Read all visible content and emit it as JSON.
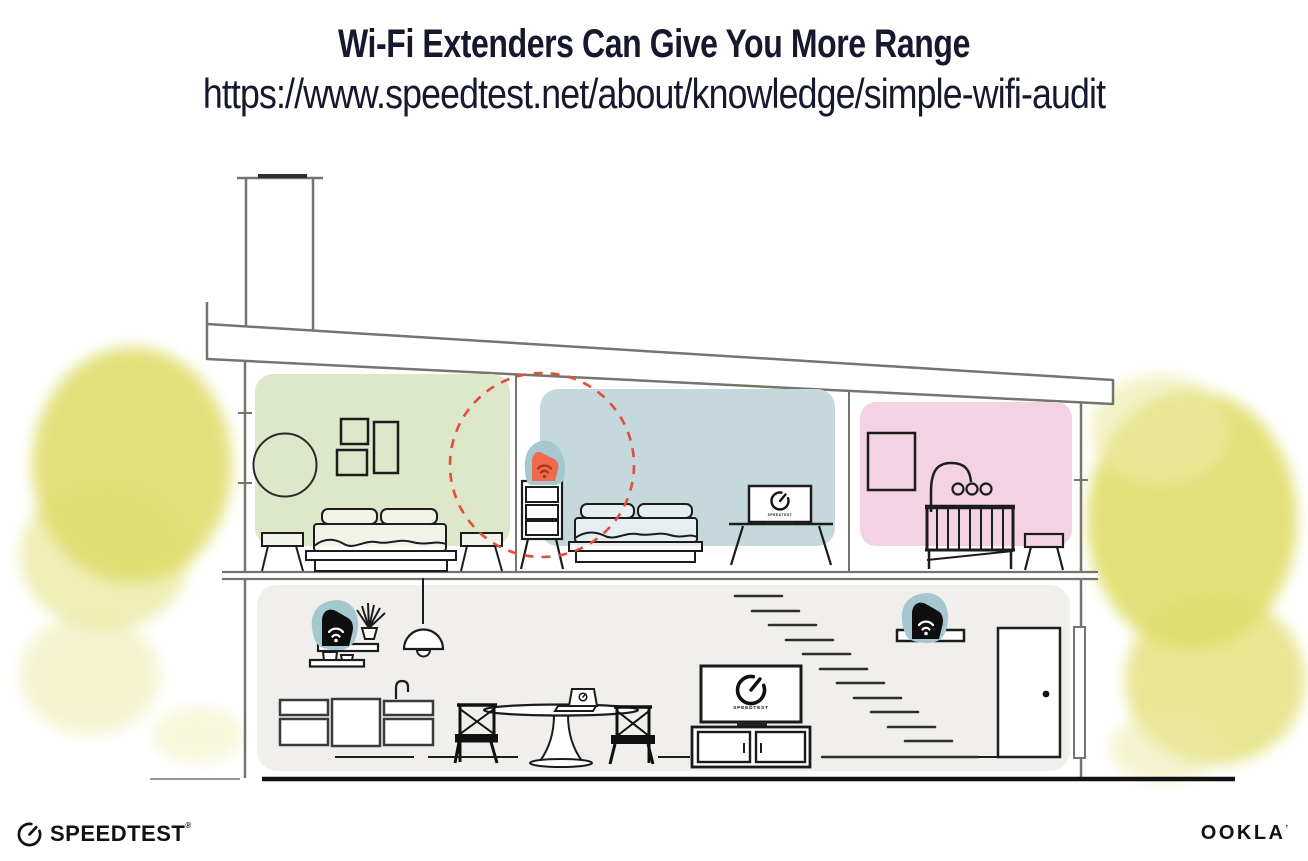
{
  "header": {
    "title": "Wi-Fi Extenders Can Give You More Range",
    "url": "https://www.speedtest.net/about/knowledge/simple-wifi-audit"
  },
  "tv_screen_label": "SPEEDTEST",
  "footer": {
    "speedtest": "SPEEDTEST",
    "speedtest_mark": "®",
    "ookla": "OOKLA",
    "ookla_mark": "’"
  },
  "icons": {
    "gauge": "speedtest-gauge",
    "wifi": "wifi-signal"
  },
  "colors": {
    "room_green": "#dde7c9",
    "room_blue": "#c5d9dd",
    "room_pink": "#f3d2e3",
    "room_gray": "#f0efec",
    "accent_teal": "#a5c8d0",
    "extender_orange": "#f16a4c",
    "wifi_dark": "#a8331f",
    "range_circle": "#e14f3a",
    "foliage": "#e0dd6e",
    "foliage_light": "#eceaa4",
    "structure": "#75756f",
    "ink": "#1c1c1c",
    "title_ink": "#16182d",
    "ground": "#121212"
  }
}
